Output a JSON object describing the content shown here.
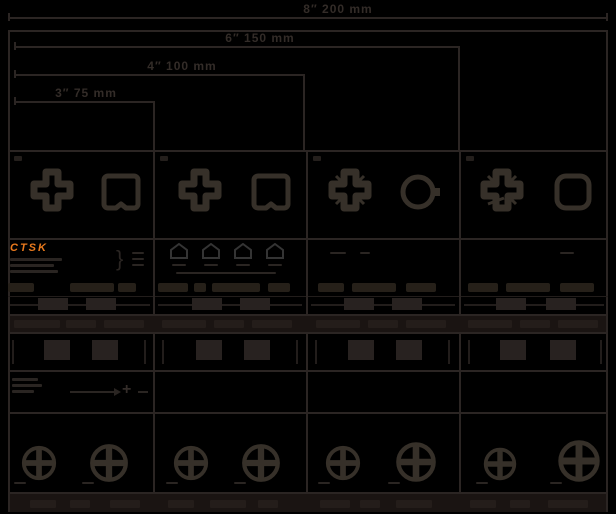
{
  "meta": {
    "background": "#000000",
    "line_color": "#2b2523",
    "icon_color": "#363029",
    "band_color": "#1a1412",
    "accent_orange": "#e8791d",
    "dim_text_color": "#332c28"
  },
  "brand": {
    "logo_text": "CTSK"
  },
  "dimension_diagram": {
    "levels": [
      {
        "label": "8″ 200 mm"
      },
      {
        "label": "6″ 150 mm"
      },
      {
        "label": "4″ 100 mm"
      },
      {
        "label": "3″ 75 mm"
      }
    ]
  },
  "icons": {
    "bit_tip": "phillips-cross-section",
    "recess": "screw-recess-outline",
    "profile": "tip-profile-pentagon",
    "screw": "phillips-screw-head-top",
    "pointer": "arrow-to-bit-tip"
  },
  "table": {
    "columns": 4,
    "rows": [
      "length-dimensions",
      "bit-and-recess-icons",
      "description",
      "part-chips",
      "code-line",
      "banner-band",
      "code-boxes",
      "pointer-illustration",
      "screw-heads",
      "footer-band"
    ]
  }
}
